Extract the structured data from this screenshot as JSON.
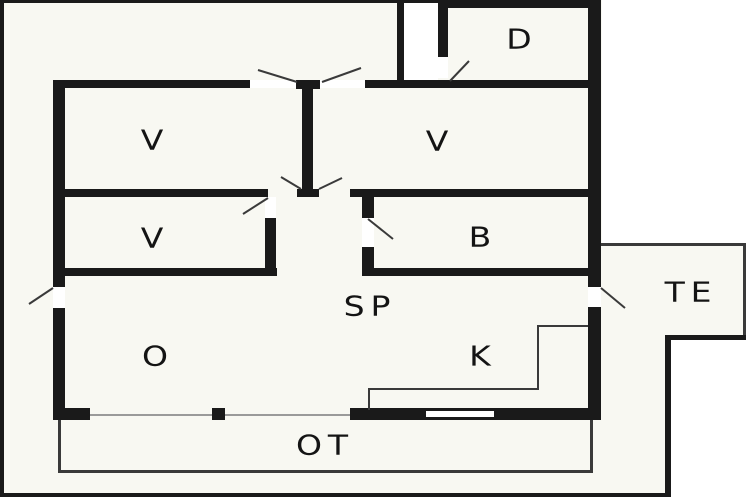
{
  "plan": {
    "colors": {
      "wall": "#1a1a1a",
      "paper": "#f8f8f2",
      "outside": "#ffffff",
      "line": "#3a3a3a",
      "sill": "#9a9a9a",
      "text": "#141414"
    },
    "rooms": {
      "d": {
        "label": "D"
      },
      "v_top_left": {
        "label": "V"
      },
      "v_top_right": {
        "label": "V"
      },
      "v_mid_left": {
        "label": "V"
      },
      "b": {
        "label": "B"
      },
      "sp": {
        "label": "SP"
      },
      "te": {
        "label": "TE"
      },
      "o": {
        "label": "O"
      },
      "k": {
        "label": "K"
      },
      "ot": {
        "label": "OT"
      }
    }
  }
}
